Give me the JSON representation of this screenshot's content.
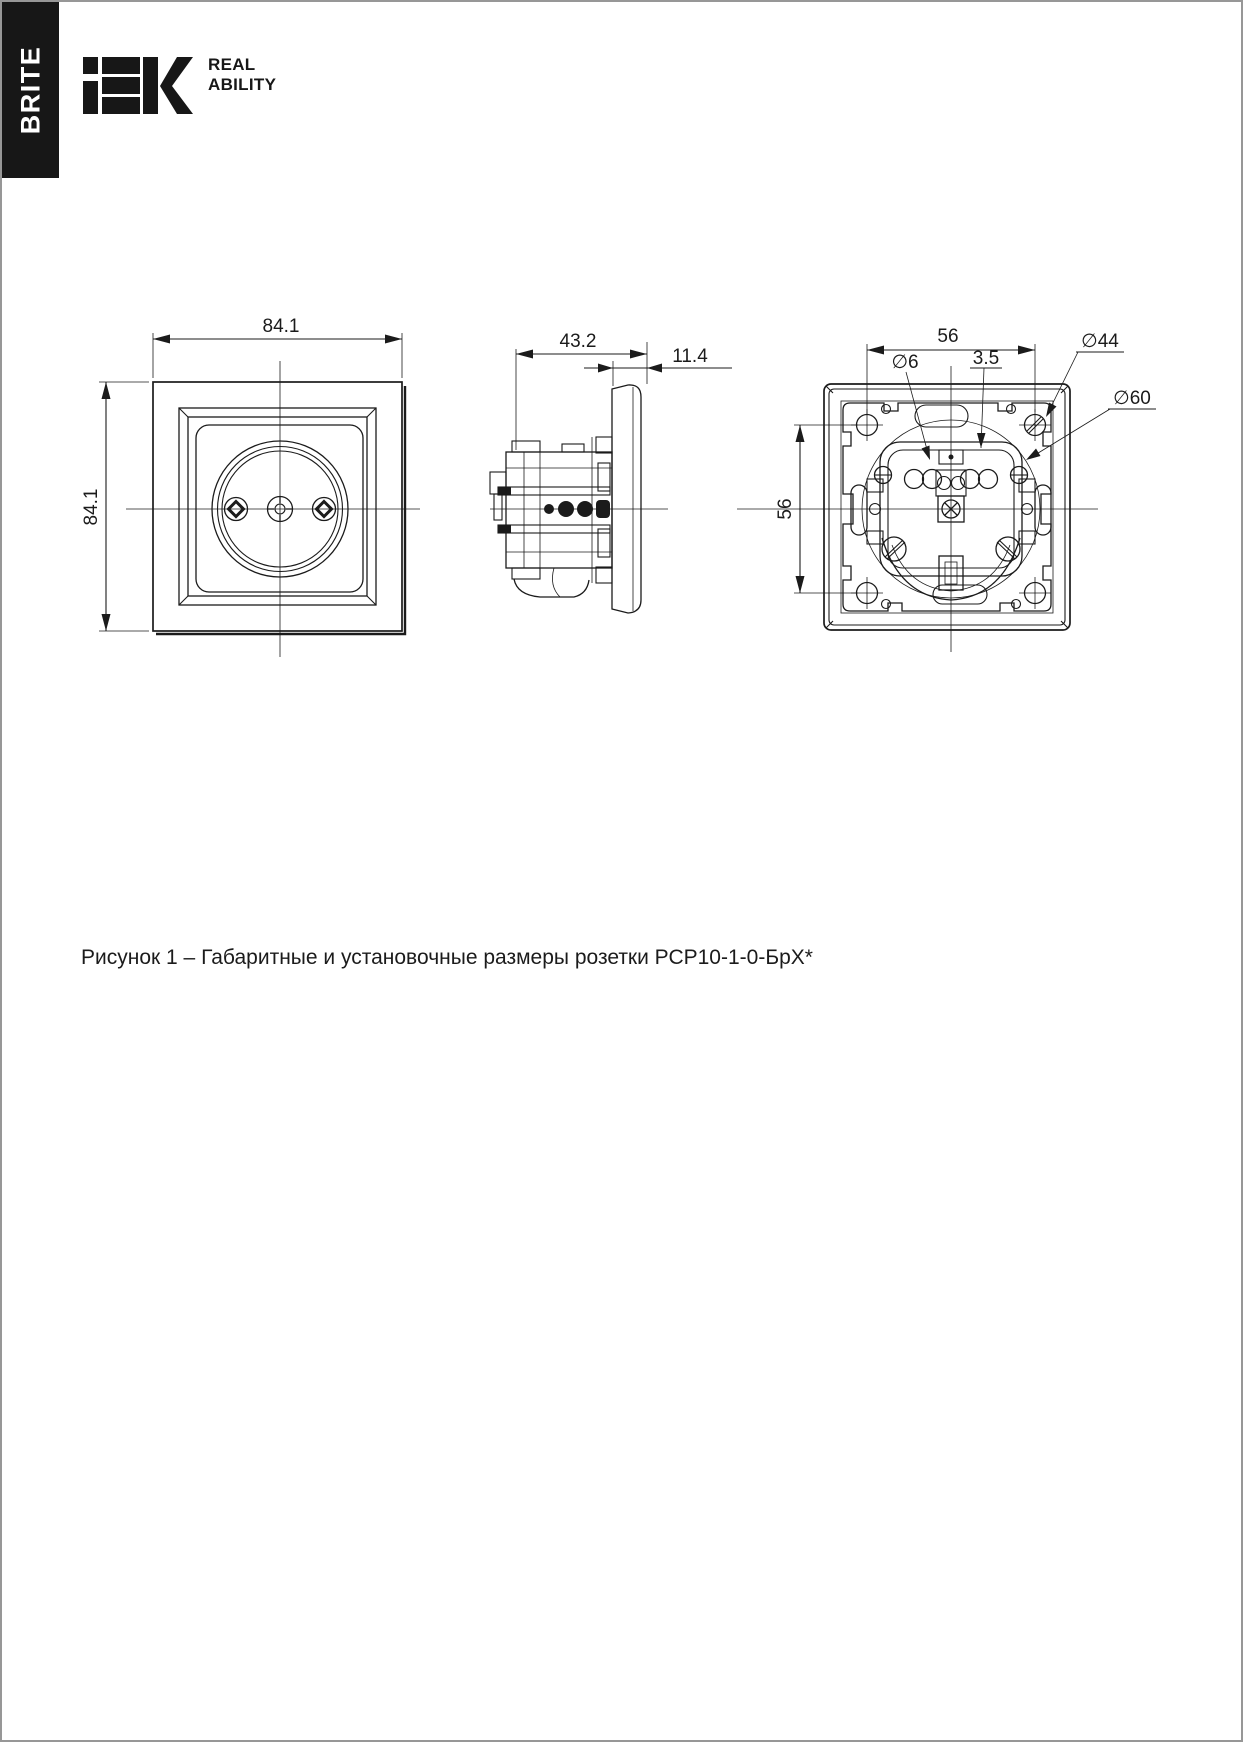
{
  "page": {
    "background": "#ffffff",
    "border_color": "#979797",
    "line_color": "#1b1b1b"
  },
  "sidebar": {
    "label": "BRITE"
  },
  "logo": {
    "brand": "iEK",
    "tagline_line1": "REAL",
    "tagline_line2": "ABILITY"
  },
  "figure": {
    "caption": "Рисунок 1 – Габаритные и установочные размеры розетки РСР10-1-0-БрХ*",
    "front_view": {
      "dim_width": "84.1",
      "dim_height": "84.1"
    },
    "side_view": {
      "dim_depth": "43.2",
      "dim_frame_thickness": "11.4"
    },
    "back_view": {
      "dim_mount_spacing_horizontal": "56",
      "dim_mount_spacing_vertical": "56",
      "dim_mount_hole_diameter": "∅6",
      "dim_gap": "3.5",
      "dim_screw_circle_diameter": "∅44",
      "dim_recess_diameter": "∅60"
    }
  }
}
